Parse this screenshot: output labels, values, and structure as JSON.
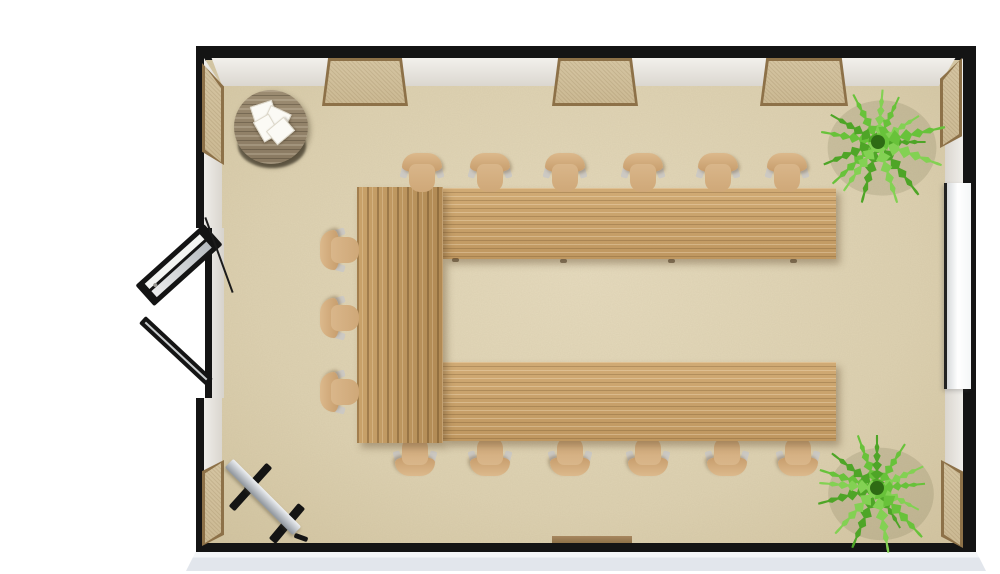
{
  "meta": {
    "type": "floor-plan",
    "description": "3D overhead rendering of a classroom / seminar room with U-shaped table layout",
    "canvas": {
      "w": 1000,
      "h": 574
    }
  },
  "colors": {
    "outside": "#ffffff",
    "slab-side": "#e2e6ec",
    "wall-edge": "#141414",
    "floor": "#ddd1b1",
    "window-fill": "#d4c4a1",
    "window-frame": "#8d7148",
    "chair-seat": "#d9b68a",
    "chair-back": "#c79d6c",
    "coffee-table": "#897961",
    "board-frame": "#222222",
    "door": "#141414",
    "plant-greens": [
      "#4ea527",
      "#68c23a",
      "#83d153"
    ]
  },
  "room": {
    "outer": {
      "x": 196,
      "y": 46,
      "w": 780,
      "h": 506
    },
    "floor": {
      "x": 206,
      "y": 60,
      "w": 757,
      "h": 483
    },
    "slab": {
      "x": 186,
      "y": 552,
      "w": 800,
      "h": 19
    },
    "faces": {
      "top": {
        "x": 204,
        "y": 58,
        "w": 759,
        "h": 28
      },
      "left": {
        "x": 204,
        "y": 58,
        "w": 18,
        "h": 485
      },
      "right": {
        "x": 945,
        "y": 58,
        "w": 18,
        "h": 485
      }
    },
    "windows": {
      "top_wall": [
        {
          "x": 322,
          "y": 58,
          "w": 86,
          "h": 48
        },
        {
          "x": 552,
          "y": 58,
          "w": 86,
          "h": 48
        },
        {
          "x": 760,
          "y": 58,
          "w": 88,
          "h": 48
        }
      ],
      "left_wall": [
        {
          "x": 202,
          "y": 63,
          "w": 22,
          "h": 102,
          "lean": "ld"
        },
        {
          "x": 202,
          "y": 460,
          "w": 22,
          "h": 86,
          "lean": "lu"
        }
      ],
      "right_wall": [
        {
          "x": 940,
          "y": 58,
          "w": 22,
          "h": 90,
          "lean": "rd"
        },
        {
          "x": 941,
          "y": 460,
          "w": 22,
          "h": 88,
          "lean": "ru"
        }
      ],
      "bottom_sill": {
        "x": 552,
        "y": 536,
        "w": 80,
        "h": 7
      }
    },
    "door": {
      "wall": "left",
      "type": "double-glass",
      "state": "open-outward",
      "gap": {
        "x": 150,
        "y": 228,
        "w": 56,
        "h": 170
      },
      "jamb": {
        "x": 205,
        "y": 228,
        "w": 7,
        "h": 170
      },
      "threshold": {
        "x": 212,
        "y": 228,
        "w": 12,
        "h": 170
      },
      "leaf1": {
        "cx": 179,
        "cy": 265,
        "len": 92,
        "thick": 28,
        "angle": -42
      },
      "leaf2": {
        "cx": 176,
        "cy": 351,
        "len": 92,
        "thick": 10,
        "angle": 43
      },
      "rod": {
        "cx": 219,
        "cy": 255,
        "len": 80,
        "thick": 2,
        "angle": 70
      }
    }
  },
  "furniture": {
    "u_table": {
      "left_segment": {
        "x": 357,
        "y": 187,
        "w": 86,
        "h": 256
      },
      "top_segment": {
        "x": 443,
        "y": 188,
        "w": 393,
        "h": 71
      },
      "bottom_segment": {
        "x": 443,
        "y": 362,
        "w": 393,
        "h": 79
      },
      "legs": [
        {
          "x": 452,
          "y": 258
        },
        {
          "x": 560,
          "y": 259
        },
        {
          "x": 668,
          "y": 259
        },
        {
          "x": 790,
          "y": 259
        }
      ]
    },
    "chairs": {
      "total": 15,
      "top_row": {
        "y": 150,
        "x": [
          422,
          490,
          565,
          643,
          718,
          787
        ]
      },
      "bottom_row": {
        "y": 433,
        "x": [
          415,
          490,
          570,
          648,
          727,
          798
        ]
      },
      "left_column": {
        "x": 318,
        "y": [
          227,
          295,
          369
        ]
      }
    },
    "coffee_table": {
      "cx": 271,
      "cy": 127,
      "r": 37,
      "shadow": {
        "cx": 272,
        "cy": 146,
        "rx": 34,
        "ry": 22
      },
      "papers": [
        {
          "x": 252,
          "y": 103,
          "rot": -18
        },
        {
          "x": 266,
          "y": 109,
          "rot": 25
        },
        {
          "x": 255,
          "y": 119,
          "rot": 60
        },
        {
          "x": 269,
          "y": 122,
          "rot": -40
        }
      ]
    },
    "whiteboard": {
      "x": 944,
      "y": 183,
      "w": 24,
      "h": 206
    },
    "flipchart": {
      "board": {
        "cx": 263,
        "cy": 497,
        "len": 96,
        "thick": 12,
        "angle": 45
      },
      "legs": [
        {
          "cx": 258,
          "cy": 478,
          "len": 34,
          "thick": 8,
          "angle": -48
        },
        {
          "cx": 243,
          "cy": 496,
          "len": 34,
          "thick": 8,
          "angle": -48
        },
        {
          "cx": 287,
          "cy": 523,
          "len": 46,
          "thick": 9,
          "angle": -50
        },
        {
          "cx": 301,
          "cy": 537,
          "len": 14,
          "thick": 5,
          "angle": 20
        }
      ]
    },
    "plants": [
      {
        "cx": 878,
        "cy": 142,
        "r": 68,
        "fronds": 15
      },
      {
        "cx": 877,
        "cy": 488,
        "r": 66,
        "fronds": 15
      }
    ]
  }
}
